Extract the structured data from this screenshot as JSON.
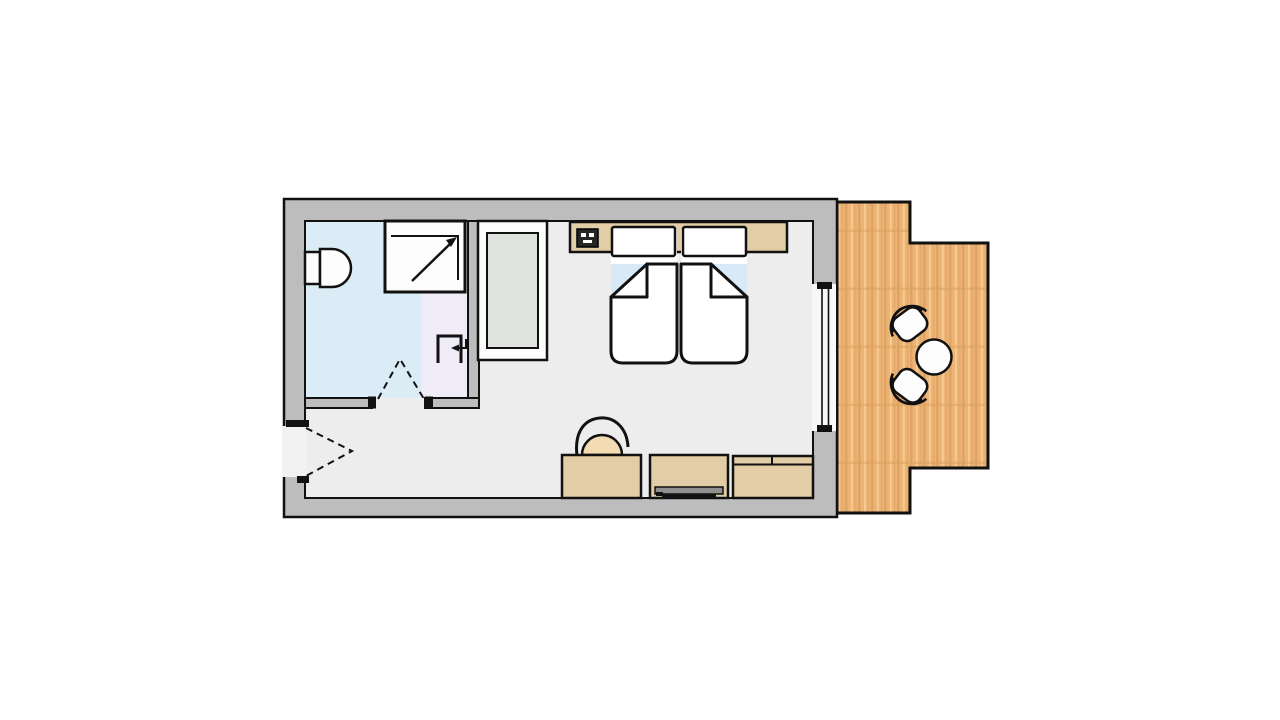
{
  "plan": {
    "kind": "hotel-room-floor-plan",
    "rooms": [
      "bathroom",
      "vestibule",
      "bedroom",
      "balcony"
    ],
    "fixtures": [
      "toilet",
      "shower",
      "washbasin",
      "bathroom-door",
      "entrance-door",
      "wardrobe",
      "twin-bed-left",
      "twin-bed-right",
      "headboard-shelf",
      "telephone",
      "desk",
      "desk-chair",
      "tv-lowboard",
      "tv",
      "sideboard",
      "sliding-glass-door",
      "balcony-table",
      "balcony-chair-upper",
      "balcony-chair-lower"
    ]
  },
  "colors": {
    "outline": "#111111",
    "wall": "#bdbdbd",
    "floor": "#ededed",
    "bath": "#dcecf7",
    "vestibule": "#efecf8",
    "sheet": "#d8e9f7",
    "furniture": "#e2cda6",
    "chairSeat": "#f3dcb4",
    "wardrobeInner": "#dfe3dd",
    "wood": "#ecb577",
    "woodDark": "#dca05c",
    "woodLight": "#f7cd93",
    "glassArea": "#f8f8f8",
    "opening": "#f1f1f1",
    "white": "#fdfdfd",
    "tvGray": "#8f8f8f",
    "phoneDark": "#262626"
  }
}
